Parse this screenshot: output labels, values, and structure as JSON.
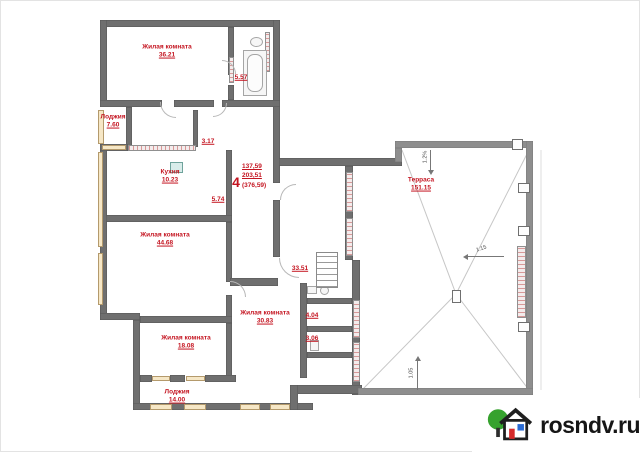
{
  "watermark": {
    "text": "rosndv.ru",
    "logo": "house-with-tree-icon"
  },
  "plan": {
    "unit": {
      "number": "4",
      "area_living": "137,59",
      "area_total": "203,51",
      "area_full": "(376,59)"
    },
    "rooms": [
      {
        "name": "Жилая комната",
        "area": "36.21"
      },
      {
        "name": "",
        "area": "5.57"
      },
      {
        "name": "Лоджия",
        "area": "7.60"
      },
      {
        "name": "",
        "area": "3.17"
      },
      {
        "name": "Кухня",
        "area": "10.23"
      },
      {
        "name": "",
        "area": "5.74"
      },
      {
        "name": "Жилая комната",
        "area": "44.68"
      },
      {
        "name": "",
        "area": "33.51"
      },
      {
        "name": "Жилая комната",
        "area": "30.83"
      },
      {
        "name": "",
        "area": "4.04"
      },
      {
        "name": "",
        "area": "3.06"
      },
      {
        "name": "Жилая комната",
        "area": "18.08"
      },
      {
        "name": "Лоджия",
        "area": "14.00"
      },
      {
        "name": "Терраса",
        "area": "151.15"
      }
    ],
    "slope_annotations": [
      "1.2%",
      "1.15",
      "1.05"
    ],
    "colors": {
      "wall": "#6f6f6f",
      "terrace_wall": "#8e8e8e",
      "label_red": "#c41420",
      "window": "#f6e7c6"
    }
  }
}
